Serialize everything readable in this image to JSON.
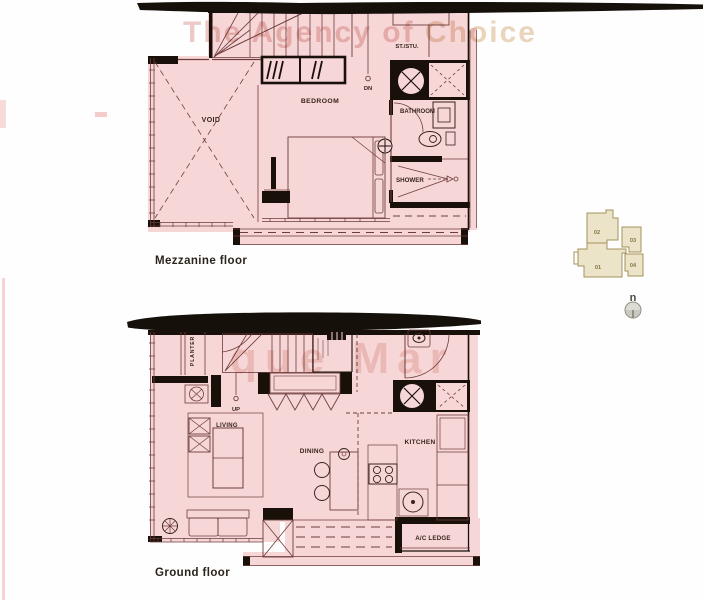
{
  "watermarks": {
    "agency_prefix": "The Agency of ",
    "agency_suffix": "Choice",
    "scan_text": "que Mar"
  },
  "mezzanine_floor": {
    "caption": "Mezzanine floor",
    "rooms": {
      "void": "VOID",
      "bedroom": "BEDROOM",
      "store_studio": "ST./STU.",
      "bathroom": "BATHROOM",
      "shower": "SHOWER"
    },
    "stair_label": "DN"
  },
  "ground_floor": {
    "caption": "Ground floor",
    "rooms": {
      "planter": "PLANTER",
      "living": "LIVING",
      "dining": "DINING",
      "kitchen": "KITCHEN",
      "ac_ledge": "A/C LEDGE"
    },
    "stair_label": "UP"
  },
  "key_plan": {
    "units": [
      "02",
      "03",
      "01",
      "04"
    ],
    "north_label": "n"
  },
  "colors": {
    "plan_fill": "#f7d6d8",
    "wall": "#1a100a",
    "line": "#6e3d3b",
    "keyplan_fill": "#ebe4c9",
    "keyplan_outline": "#a5925a"
  }
}
